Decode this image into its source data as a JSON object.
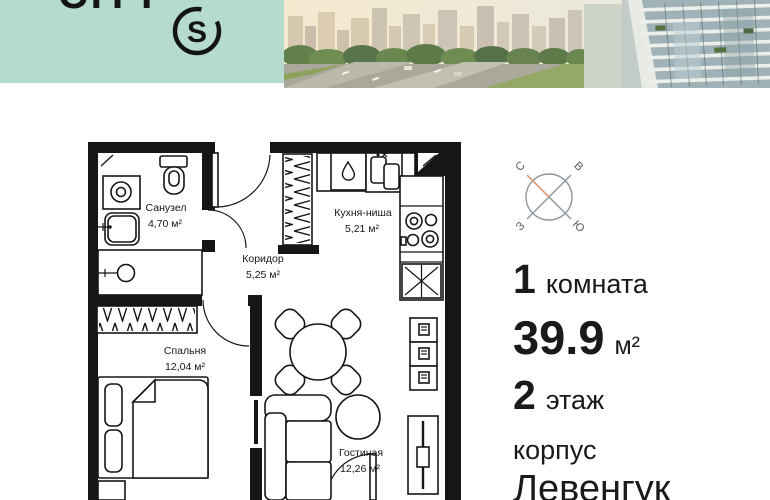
{
  "header": {
    "brand_text": "CITY",
    "logo_letter": "S"
  },
  "compass": {
    "north": "С",
    "east": "В",
    "west": "З",
    "south": "Ю"
  },
  "plan": {
    "rooms": [
      {
        "name": "Санузел",
        "area": "4,70 м²"
      },
      {
        "name": "Коридор",
        "area": "5,25 м²"
      },
      {
        "name": "Кухня-ниша",
        "area": "5,21 м²"
      },
      {
        "name": "Спальня",
        "area": "12,04 м²"
      },
      {
        "name": "Гостиная",
        "area": "12,26 м²"
      }
    ]
  },
  "details": {
    "rooms_count": "1",
    "rooms_label": "комната",
    "area_value": "39.9",
    "area_unit": "м²",
    "floor_value": "2",
    "floor_label": "этаж",
    "building_label": "корпус",
    "building_name": "Левенгук"
  },
  "colors": {
    "brand_mint": "#b5dbd0",
    "compass_north": "#dd9b71",
    "walls": "#161616"
  }
}
